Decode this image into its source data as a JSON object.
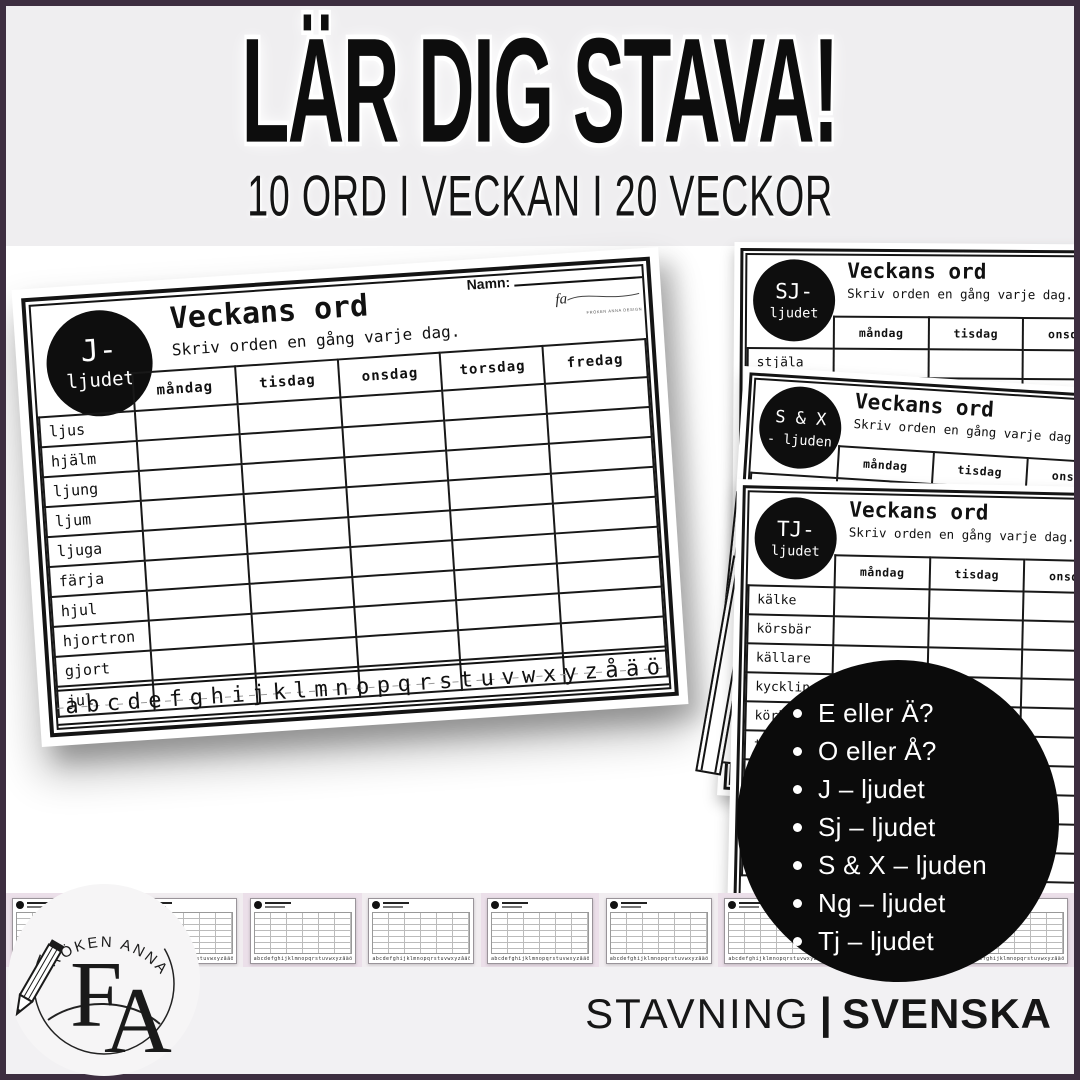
{
  "header": {
    "title": "LÄR DIG STAVA!",
    "subtitle": "10 ORD I VECKAN I 20 VECKOR"
  },
  "worksheet_common": {
    "title": "Veckans ord",
    "instruction": "Skriv orden en gång varje dag.",
    "name_label": "Namn:",
    "days": [
      "måndag",
      "tisdag",
      "onsdag",
      "torsdag",
      "fredag"
    ],
    "alphabet": "abcdefghijklmnopqrstuvwxyzåäö",
    "signature_script": "fa",
    "signature_caption": "FRÖKEN ANNA DESIGN"
  },
  "worksheets": {
    "j": {
      "badge_line1": "J-",
      "badge_line2": "ljudet",
      "words": [
        "ljus",
        "hjälm",
        "ljung",
        "ljum",
        "ljuga",
        "färja",
        "hjul",
        "hjortron",
        "gjort",
        "jul"
      ]
    },
    "sj": {
      "badge_line1": "SJ-",
      "badge_line2": "ljudet",
      "words": [
        "stjäla",
        "sjöstjärna"
      ]
    },
    "sx": {
      "badge_line1": "S & X",
      "badge_line2": "- ljuden",
      "words": [
        "tacksam"
      ]
    },
    "tj": {
      "badge_line1": "TJ-",
      "badge_line2": "ljudet",
      "words": [
        "kälke",
        "körsbär",
        "källare",
        "kyckling",
        "körkort",
        "tj"
      ]
    }
  },
  "topics_circle": {
    "items": [
      "E eller Ä?",
      "O eller Å?",
      "J – ljudet",
      "Sj – ljudet",
      "S & X – ljuden",
      "Ng – ljudet",
      "Tj – ljudet"
    ]
  },
  "logo": {
    "arc_text": "FRÖKEN ANNA",
    "monogram_f": "F",
    "monogram_a": "A"
  },
  "bottom_strip": {
    "thumbnail_count": 9
  },
  "footer": {
    "category": "STAVNING",
    "separator": "|",
    "subject": "SVENSKA"
  },
  "colors": {
    "frame_purple": "#3D2E40",
    "banner_gray": "#EFEEF0",
    "strip_pink": "#EBDFE9",
    "footer_band": "#F2F1F3",
    "ink_black": "#141414",
    "white": "#FFFFFF"
  }
}
